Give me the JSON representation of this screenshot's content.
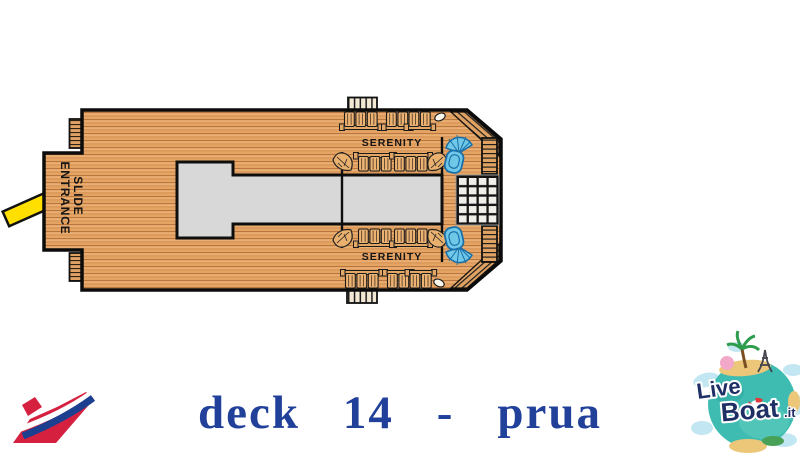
{
  "deck_plan": {
    "serenity_top": "SERENITY",
    "serenity_bottom": "SERENITY",
    "slide_entrance_line1": "SLIDE",
    "slide_entrance_line2": "ENTRANCE"
  },
  "caption": {
    "text": "deck 14 - prua",
    "color": "#21409a"
  },
  "liveboat_logo": {
    "live": "Live",
    "boat": "Boat",
    "it": ".it"
  },
  "colors": {
    "deck_wood": "#e4a463",
    "plank_line": "#b9763e",
    "outline": "#0b0b0b",
    "slide_yellow": "#ffdf00",
    "structure_gray": "#d8d8d8",
    "spa_blue": "#6fc8e7",
    "spa_blue_dark": "#1b6fa8",
    "caption_blue": "#21409a",
    "carnival_red": "#d62040",
    "carnival_blue": "#1d3f90",
    "globe_teal": "#3fbcb1",
    "logo_navy": "#1e2f66"
  }
}
